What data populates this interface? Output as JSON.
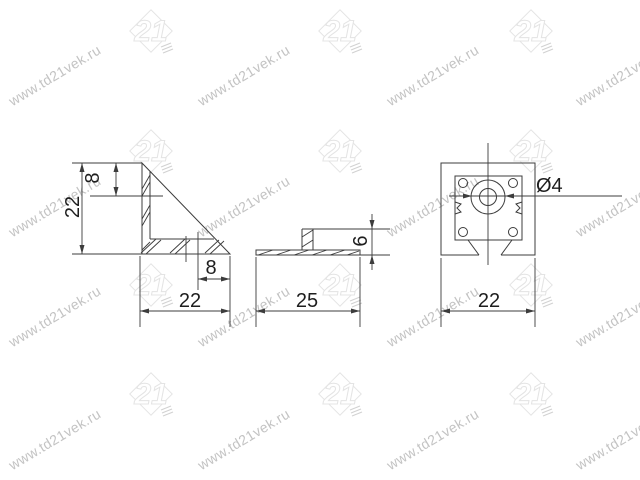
{
  "page": {
    "background": "#ffffff"
  },
  "watermark": {
    "text": "www.td21vek.ru",
    "text_color": "#c3c3c3",
    "font_size": 14,
    "angle_deg": -31,
    "text_columns_x": [
      14,
      203,
      392,
      581
    ],
    "text_rows_y": [
      57,
      188,
      298,
      421
    ],
    "logo_label": "21",
    "logo_color": "#e4e4e4",
    "logo_accent_color": "#d2d2d2",
    "logo_columns_x": [
      125,
      314,
      505
    ],
    "logo_rows_y": [
      3,
      123,
      257,
      366
    ]
  },
  "drawing": {
    "line_color": "#3c3c3c",
    "dim_text_color": "#1e1e1e",
    "views": {
      "side": {
        "title": "side-view-of-corner-bracket",
        "dim_height": "22",
        "dim_top_offset": "8",
        "dim_bottom_offset": "8",
        "dim_width": "22"
      },
      "front": {
        "title": "front-view-of-corner-bracket",
        "dim_width": "25",
        "dim_height": "6"
      },
      "top": {
        "title": "top-view-of-corner-bracket",
        "dim_width": "22",
        "dim_hole": "Ø4"
      }
    }
  }
}
